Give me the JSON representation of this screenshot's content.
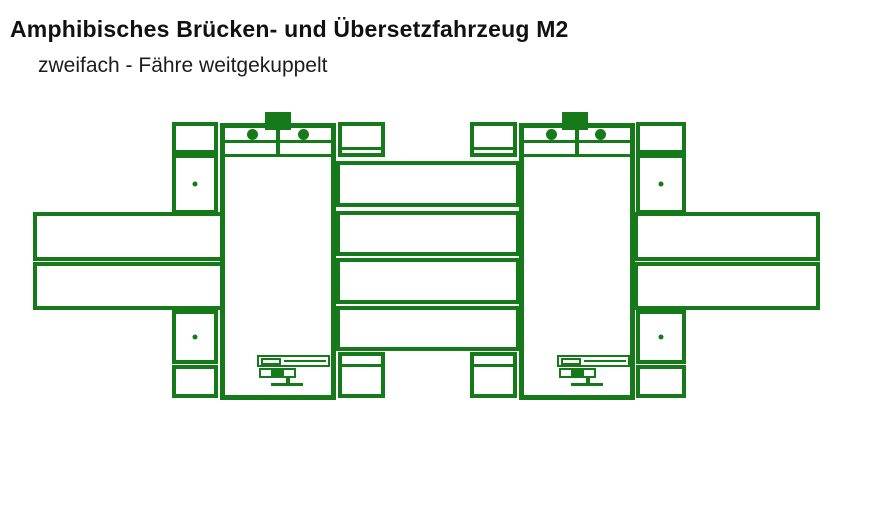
{
  "header": {
    "title": "Amphibisches Brücken- und Übersetzfahrzeug M2",
    "subtitle": "zweifach - Fähre weitgekuppelt"
  },
  "colors": {
    "diagram_green": "#177a1a",
    "text_black": "#111111",
    "background": "#ffffff"
  }
}
